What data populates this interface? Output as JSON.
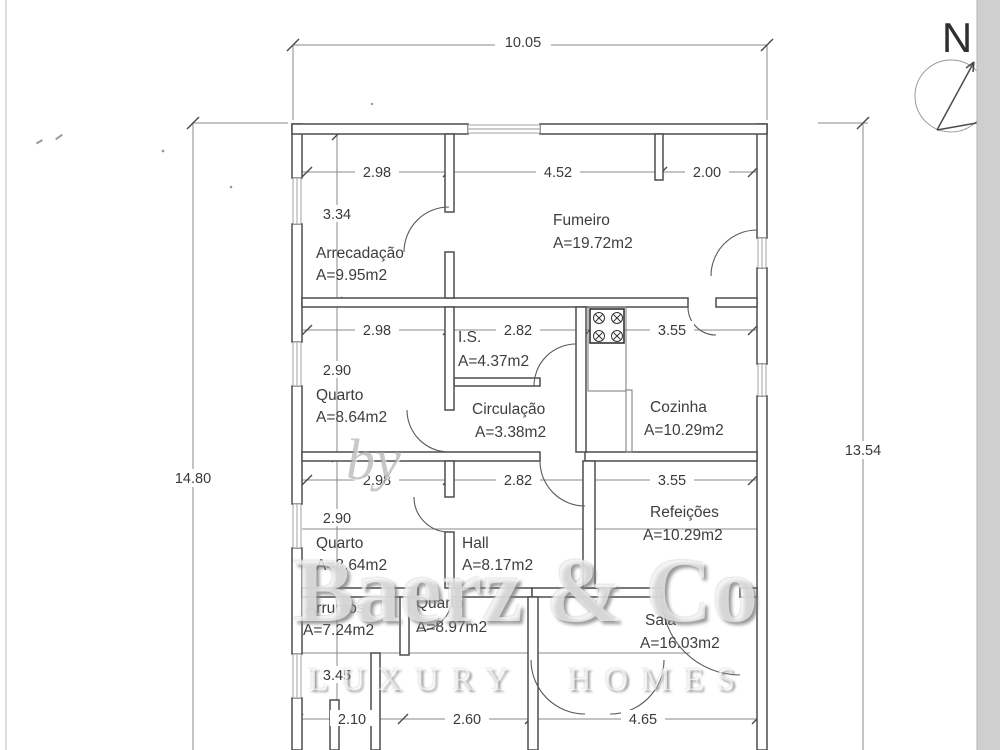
{
  "plan": {
    "north_label": "N",
    "dimensions": {
      "overall_width": "10.05",
      "height_left": "14.80",
      "height_right": "13.54",
      "row_top": [
        "2.98",
        "4.52",
        "2.00"
      ],
      "row_middle": [
        "2.98",
        "2.82",
        "3.55"
      ],
      "row_lower": [
        "2.98",
        "2.82",
        "3.55"
      ],
      "row_bottom": [
        "2.10",
        "2.60",
        "4.65"
      ],
      "column_left": [
        "3.34",
        "2.90",
        "2.90",
        "3.45"
      ]
    },
    "rooms": [
      {
        "name": "Arrecadação",
        "area": "A=9.95m2"
      },
      {
        "name": "Fumeiro",
        "area": "A=19.72m2"
      },
      {
        "name": "I.S.",
        "area": "A=4.37m2"
      },
      {
        "name": "Quarto",
        "area": "A=8.64m2"
      },
      {
        "name": "Circulação",
        "area": "A=3.38m2"
      },
      {
        "name": "Cozinha",
        "area": "A=10.29m2"
      },
      {
        "name": "Quarto",
        "area": "A=8.64m2"
      },
      {
        "name": "Hall",
        "area": "A=8.17m2"
      },
      {
        "name": "Refeições",
        "area": "A=10.29m2"
      },
      {
        "name": "Arrumos",
        "area": "A=7.24m2"
      },
      {
        "name": "Quarto",
        "area": "A=8.97m2"
      },
      {
        "name": "Sala",
        "area": "A=16.03m2"
      }
    ]
  },
  "watermark": {
    "prefix": "by",
    "brand": "Baerz & Co",
    "tagline": "LUXURY HOMES"
  }
}
